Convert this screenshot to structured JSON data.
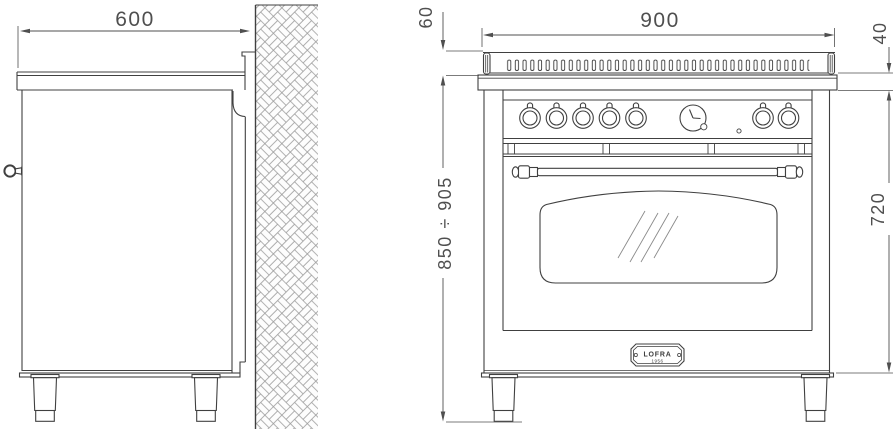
{
  "drawing": {
    "kind": "appliance installation dimension drawing",
    "views": [
      "side view against wall",
      "front view of range cooker"
    ]
  },
  "dims": {
    "side_depth": "600",
    "front_width": "900",
    "backguard_height": "60",
    "worktop_edge": "40",
    "overall_height": "850 ÷ 905",
    "body_height": "720"
  },
  "badge": {
    "brand": "LOFRA",
    "year": "1956"
  },
  "features": {
    "burner_knobs_left": "5",
    "burner_knobs_right": "2",
    "has_clock_timer": true,
    "oven_window": true,
    "towel_bar_handle": true
  },
  "colors": {
    "line": "#404040",
    "dim_text": "#4f4f4f",
    "hatch": "#9a9a9a",
    "background": "#ffffff"
  }
}
